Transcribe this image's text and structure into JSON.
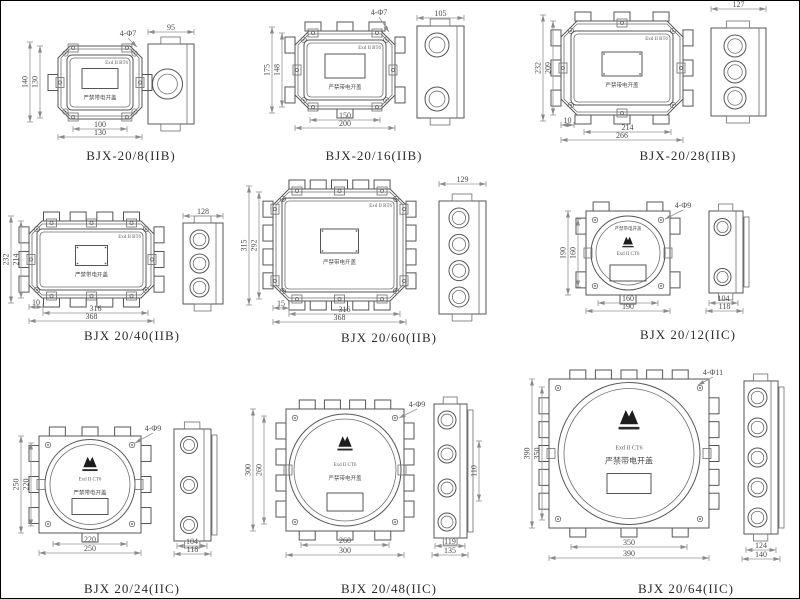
{
  "sheet": {
    "width": 800,
    "height": 599,
    "background": "#ffffff",
    "line_color": "#565656",
    "dim_color": "#949494"
  },
  "panels": [
    {
      "id": "bjx-20-8",
      "caption": "BJX-20/8(IIB)",
      "type": "rect",
      "marking": "Exd II BT6",
      "warning": "严禁带电开盖",
      "logo": false,
      "front": {
        "x": 57,
        "y": 45,
        "w": 84,
        "h": 73,
        "ch": 12,
        "ci": 9,
        "winW": 36,
        "winH": 20,
        "winDots": false
      },
      "side": {
        "x": 147,
        "y": 43,
        "w": 46,
        "h": 80,
        "holes": 1,
        "r": 15
      },
      "lugs": {
        "l": 1,
        "r": 1,
        "t": 0,
        "b": 0
      },
      "clamps": {
        "t": 2,
        "b": 2,
        "l": 1,
        "r": 1
      },
      "cap": {
        "x": 130,
        "y": 159
      },
      "dims": [
        {
          "t": "4-Φ7",
          "k": "leader",
          "x": 127,
          "y": 35,
          "tx": 136,
          "ty": 46
        },
        {
          "t": "95",
          "k": "h",
          "x1": 147,
          "x2": 193,
          "y": 31
        },
        {
          "t": "140",
          "k": "v",
          "x": 29,
          "y1": 41,
          "y2": 121
        },
        {
          "t": "130",
          "k": "v",
          "x": 39,
          "y1": 45,
          "y2": 117
        },
        {
          "t": "100",
          "k": "h",
          "x1": 72,
          "x2": 126,
          "y": 128
        },
        {
          "t": "130",
          "k": "h",
          "x1": 57,
          "x2": 141,
          "y": 136
        }
      ]
    },
    {
      "id": "bjx-20-16",
      "caption": "BJX-20/16(IIB)",
      "type": "rect",
      "marking": "Exd II BT6",
      "warning": "严禁带电开盖",
      "logo": false,
      "front": {
        "x": 294,
        "y": 30,
        "w": 100,
        "h": 78,
        "ch": 14,
        "ci": 9,
        "winW": 40,
        "winH": 24,
        "winDots": false
      },
      "side": {
        "x": 416,
        "y": 25,
        "w": 47,
        "h": 92,
        "holes": 2,
        "r": 12
      },
      "lugs": {
        "l": 2,
        "r": 2,
        "t": 3,
        "b": 1
      },
      "clamps": {
        "t": 2,
        "b": 2,
        "l": 1,
        "r": 1
      },
      "cap": {
        "x": 373,
        "y": 159
      },
      "dims": [
        {
          "t": "4-Φ7",
          "k": "leader",
          "x": 378,
          "y": 14,
          "tx": 388,
          "ty": 31
        },
        {
          "t": "105",
          "k": "h",
          "x1": 416,
          "x2": 463,
          "y": 17
        },
        {
          "t": "175",
          "k": "v",
          "x": 271,
          "y1": 26,
          "y2": 112
        },
        {
          "t": "148",
          "k": "v",
          "x": 281,
          "y1": 32,
          "y2": 106
        },
        {
          "t": "150",
          "k": "h",
          "x1": 309,
          "x2": 379,
          "y": 119
        },
        {
          "t": "200",
          "k": "h",
          "x1": 294,
          "x2": 394,
          "y": 127
        }
      ]
    },
    {
      "id": "bjx-20-28",
      "caption": "BJX-20/28(IIB)",
      "type": "rect",
      "marking": "Exd II BT6",
      "warning": "严禁带电开盖",
      "logo": false,
      "front": {
        "x": 560,
        "y": 20,
        "w": 122,
        "h": 94,
        "ch": 16,
        "ci": 10,
        "winW": 40,
        "winH": 24,
        "winDots": true
      },
      "side": {
        "x": 710,
        "y": 27,
        "w": 55,
        "h": 88,
        "holes": 3,
        "r": 11
      },
      "lugs": {
        "l": 3,
        "r": 3,
        "t": 3,
        "b": 3
      },
      "clamps": {
        "t": 1,
        "b": 1,
        "l": 1,
        "r": 1
      },
      "cap": {
        "x": 687,
        "y": 159
      },
      "dims": [
        {
          "t": "127",
          "k": "h",
          "x1": 710,
          "x2": 765,
          "y": 8
        },
        {
          "t": "232",
          "k": "v",
          "x": 542,
          "y1": 14,
          "y2": 120
        },
        {
          "t": "209",
          "k": "v",
          "x": 552,
          "y1": 20,
          "y2": 114
        },
        {
          "t": "10",
          "k": "h",
          "x1": 560,
          "x2": 573,
          "y": 124
        },
        {
          "t": "214",
          "k": "h",
          "x1": 583,
          "x2": 670,
          "y": 131
        },
        {
          "t": "266",
          "k": "h",
          "x1": 560,
          "x2": 682,
          "y": 139
        }
      ]
    },
    {
      "id": "bjx-20-40",
      "caption": "BJX 20/40(IIB)",
      "type": "rect",
      "marking": "Exd II BT6",
      "warning": "严禁带电开盖",
      "logo": false,
      "front": {
        "x": 28,
        "y": 220,
        "w": 125,
        "h": 77,
        "ch": 13,
        "ci": 8,
        "winW": 32,
        "winH": 20,
        "winDots": true
      },
      "side": {
        "x": 182,
        "y": 222,
        "w": 40,
        "h": 81,
        "holes": 3,
        "r": 9.5
      },
      "lugs": {
        "l": 3,
        "r": 3,
        "t": 4,
        "b": 4
      },
      "clamps": {
        "t": 3,
        "b": 3,
        "l": 1,
        "r": 1
      },
      "cap": {
        "x": 131,
        "y": 339
      },
      "dims": [
        {
          "t": "128",
          "k": "h",
          "x1": 182,
          "x2": 222,
          "y": 215
        },
        {
          "t": "232",
          "k": "v",
          "x": 10,
          "y1": 215,
          "y2": 302
        },
        {
          "t": "214",
          "k": "v",
          "x": 20,
          "y1": 220,
          "y2": 297
        },
        {
          "t": "10",
          "k": "h",
          "x1": 28,
          "x2": 42,
          "y": 306
        },
        {
          "t": "316",
          "k": "h",
          "x1": 42,
          "x2": 147,
          "y": 312
        },
        {
          "t": "368",
          "k": "h",
          "x1": 28,
          "x2": 153,
          "y": 320
        }
      ]
    },
    {
      "id": "bjx-20-60",
      "caption": "BJX 20/60(IIB)",
      "type": "rect",
      "marking": "Exd II BT6",
      "warning": "严禁带电开盖",
      "logo": false,
      "front": {
        "x": 272,
        "y": 188,
        "w": 133,
        "h": 112,
        "ch": 16,
        "ci": 9,
        "winW": 38,
        "winH": 24,
        "winDots": true
      },
      "side": {
        "x": 438,
        "y": 200,
        "w": 47,
        "h": 113,
        "holes": 4,
        "r": 10
      },
      "lugs": {
        "l": 4,
        "r": 4,
        "t": 5,
        "b": 5
      },
      "clamps": {
        "t": 3,
        "b": 3,
        "l": 2,
        "r": 2
      },
      "cap": {
        "x": 388,
        "y": 341
      },
      "dims": [
        {
          "t": "129",
          "k": "h",
          "x1": 438,
          "x2": 485,
          "y": 183
        },
        {
          "t": "315",
          "k": "v",
          "x": 248,
          "y1": 185,
          "y2": 304
        },
        {
          "t": "292",
          "k": "v",
          "x": 258,
          "y1": 191,
          "y2": 298
        },
        {
          "t": "15",
          "k": "h",
          "x1": 272,
          "x2": 288,
          "y": 307
        },
        {
          "t": "316",
          "k": "h",
          "x1": 288,
          "x2": 399,
          "y": 313
        },
        {
          "t": "368",
          "k": "h",
          "x1": 272,
          "x2": 405,
          "y": 321
        }
      ]
    },
    {
      "id": "bjx-20-12",
      "caption": "BJX 20/12(IIC)",
      "type": "round",
      "marking": "Exd II CT6",
      "warning": "严禁带电开盖",
      "logo": true,
      "warnTop": true,
      "front": {
        "x": 585,
        "y": 210,
        "w": 84,
        "h": 84,
        "r1": 37,
        "r2": 32,
        "winW": 36,
        "winH": 16,
        "winDy": 12
      },
      "side": {
        "x": 708,
        "y": 210,
        "w": 34,
        "h": 82,
        "holes": 2,
        "r": 8.5
      },
      "lugs": {
        "l": 2,
        "r": 2,
        "t": 2,
        "b": 1
      },
      "cap": {
        "x": 687,
        "y": 338
      },
      "dims": [
        {
          "t": "4-Φ9",
          "k": "leader",
          "x": 682,
          "y": 207,
          "tx": 664,
          "ty": 218
        },
        {
          "t": "190",
          "k": "v",
          "x": 567,
          "y1": 210,
          "y2": 294
        },
        {
          "t": "160",
          "k": "v",
          "x": 577,
          "y1": 218,
          "y2": 286
        },
        {
          "t": "160",
          "k": "h",
          "x1": 597,
          "x2": 657,
          "y": 302
        },
        {
          "t": "190",
          "k": "h",
          "x1": 585,
          "x2": 669,
          "y": 310
        },
        {
          "t": "104",
          "k": "h",
          "x1": 708,
          "x2": 737,
          "y": 302
        },
        {
          "t": "118",
          "k": "h",
          "x1": 705,
          "x2": 742,
          "y": 310
        }
      ]
    },
    {
      "id": "bjx-20-24",
      "caption": "BJX 20/24(IIC)",
      "type": "round",
      "marking": "Exd II CT6",
      "warning": "严禁带电开盖",
      "logo": true,
      "warnTop": false,
      "front": {
        "x": 38,
        "y": 435,
        "w": 102,
        "h": 97,
        "r1": 45,
        "r2": 40,
        "winW": 36,
        "winH": 16,
        "winDy": 14
      },
      "side": {
        "x": 173,
        "y": 428,
        "w": 37,
        "h": 112,
        "holes": 3,
        "r": 8.5
      },
      "lugs": {
        "l": 3,
        "r": 3,
        "t": 3,
        "b": 1
      },
      "cap": {
        "x": 131,
        "y": 592
      },
      "dims": [
        {
          "t": "4-Φ9",
          "k": "leader",
          "x": 152,
          "y": 430,
          "tx": 134,
          "ty": 442
        },
        {
          "t": "250",
          "k": "v",
          "x": 20,
          "y1": 435,
          "y2": 532
        },
        {
          "t": "220",
          "k": "v",
          "x": 30,
          "y1": 442,
          "y2": 525
        },
        {
          "t": "220",
          "k": "h",
          "x1": 52,
          "x2": 126,
          "y": 543
        },
        {
          "t": "250",
          "k": "h",
          "x1": 38,
          "x2": 140,
          "y": 552
        },
        {
          "t": "104",
          "k": "h",
          "x1": 176,
          "x2": 206,
          "y": 545
        },
        {
          "t": "118",
          "k": "h",
          "x1": 173,
          "x2": 210,
          "y": 553
        }
      ]
    },
    {
      "id": "bjx-20-48",
      "caption": "BJX 20/48(IIC)",
      "type": "round",
      "marking": "Exd II CT6",
      "warning": "严禁带电开盖",
      "logo": true,
      "warnTop": false,
      "front": {
        "x": 285,
        "y": 408,
        "w": 118,
        "h": 122,
        "r1": 56,
        "r2": 51,
        "winW": 36,
        "winH": 18,
        "winDy": 23
      },
      "side": {
        "x": 433,
        "y": 403,
        "w": 33,
        "h": 134,
        "holes": 4,
        "r": 9
      },
      "lugs": {
        "l": 4,
        "r": 4,
        "t": 4,
        "b": 3
      },
      "cap": {
        "x": 388,
        "y": 592
      },
      "dims": [
        {
          "t": "4-Φ9",
          "k": "leader",
          "x": 416,
          "y": 406,
          "tx": 398,
          "ty": 417
        },
        {
          "t": "300",
          "k": "v",
          "x": 252,
          "y1": 408,
          "y2": 530
        },
        {
          "t": "260",
          "k": "v",
          "x": 263,
          "y1": 415,
          "y2": 523
        },
        {
          "t": "260",
          "k": "h",
          "x1": 300,
          "x2": 388,
          "y": 544
        },
        {
          "t": "300",
          "k": "h",
          "x1": 285,
          "x2": 403,
          "y": 554
        },
        {
          "t": "110",
          "k": "v",
          "x": 478,
          "y1": 440,
          "y2": 500
        },
        {
          "t": "119",
          "k": "h",
          "x1": 434,
          "x2": 464,
          "y": 545
        },
        {
          "t": "135",
          "k": "h",
          "x1": 431,
          "x2": 467,
          "y": 554
        }
      ]
    },
    {
      "id": "bjx-20-64",
      "caption": "BJX 20/64(IIC)",
      "type": "round",
      "marking": "Exd II CT6",
      "warning": "严禁带电开盖",
      "logo": true,
      "warnTop": false,
      "warnBig": true,
      "front": {
        "x": 548,
        "y": 378,
        "w": 160,
        "h": 149,
        "r1": 71,
        "r2": 65,
        "winW": 44,
        "winH": 20,
        "winDy": 20
      },
      "side": {
        "x": 743,
        "y": 380,
        "w": 34,
        "h": 153,
        "holes": 5,
        "r": 9.5
      },
      "lugs": {
        "l": 5,
        "r": 5,
        "t": 5,
        "b": 3
      },
      "cap": {
        "x": 685,
        "y": 592
      },
      "dims": [
        {
          "t": "4-Φ11",
          "k": "leader",
          "x": 712,
          "y": 374,
          "tx": 697,
          "ty": 384
        },
        {
          "t": "390",
          "k": "v",
          "x": 531,
          "y1": 378,
          "y2": 527
        },
        {
          "t": "350",
          "k": "v",
          "x": 541,
          "y1": 386,
          "y2": 519
        },
        {
          "t": "350",
          "k": "h",
          "x1": 570,
          "x2": 686,
          "y": 546
        },
        {
          "t": "390",
          "k": "h",
          "x1": 548,
          "x2": 708,
          "y": 557
        },
        {
          "t": "124",
          "k": "h",
          "x1": 745,
          "x2": 775,
          "y": 549
        },
        {
          "t": "140",
          "k": "h",
          "x1": 741,
          "x2": 779,
          "y": 558
        }
      ]
    }
  ]
}
